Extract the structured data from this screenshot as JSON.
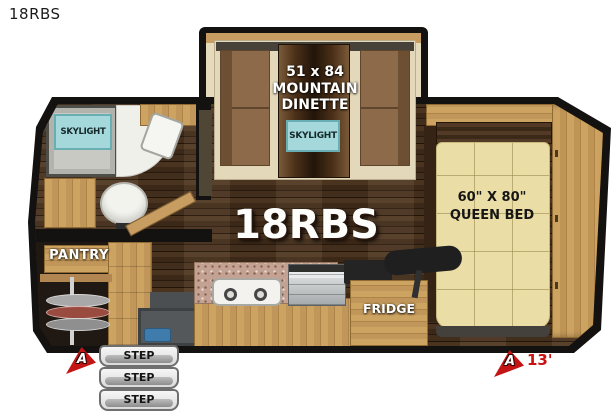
{
  "window": {
    "title": "18RBS"
  },
  "floorplan": {
    "model_label": "18RBS",
    "dinette": {
      "size_line": "51 x 84",
      "name_line1": "MOUNTAIN",
      "name_line2": "DINETTE",
      "skylight_label": "SKYLIGHT"
    },
    "bathroom": {
      "skylight_label": "SKYLIGHT"
    },
    "pantry": {
      "label": "PANTRY"
    },
    "kitchen": {
      "fridge_label": "FRIDGE"
    },
    "bedroom": {
      "bed_size_line": "60\" X 80\"",
      "bed_name_line": "QUEEN BED"
    },
    "steps": [
      "STEP",
      "STEP",
      "STEP"
    ],
    "markers": {
      "left_arrow_label": "A",
      "right_arrow_label": "A",
      "length_label": "13'"
    },
    "colors": {
      "wall": "#141210",
      "floor_wood": "#46301d",
      "cabinet_oak": "#c79d61",
      "cushion_brown": "#8d6b4a",
      "mattress_cream": "#ebdda6",
      "skylight_teal": "#a5d8da",
      "marker_red": "#c41414"
    }
  }
}
